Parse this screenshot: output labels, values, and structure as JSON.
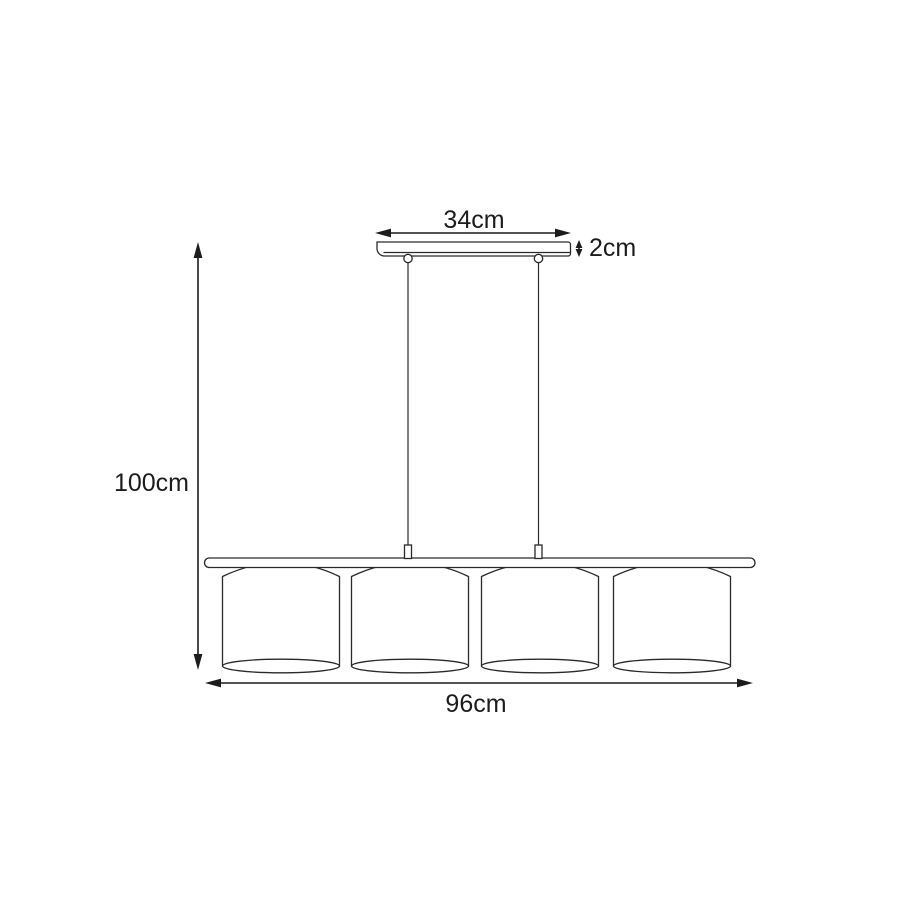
{
  "diagram": {
    "type": "product-dimension-drawing",
    "subject": "four-shade linear pendant lamp",
    "shade_count": 4,
    "dimensions": {
      "canopy_width": "34cm",
      "canopy_height": "2cm",
      "drop_height": "100cm",
      "fixture_width": "96cm"
    },
    "colors": {
      "line": "#2a2a2a",
      "dimension_line": "#1c1c1c",
      "background": "#ffffff"
    }
  }
}
